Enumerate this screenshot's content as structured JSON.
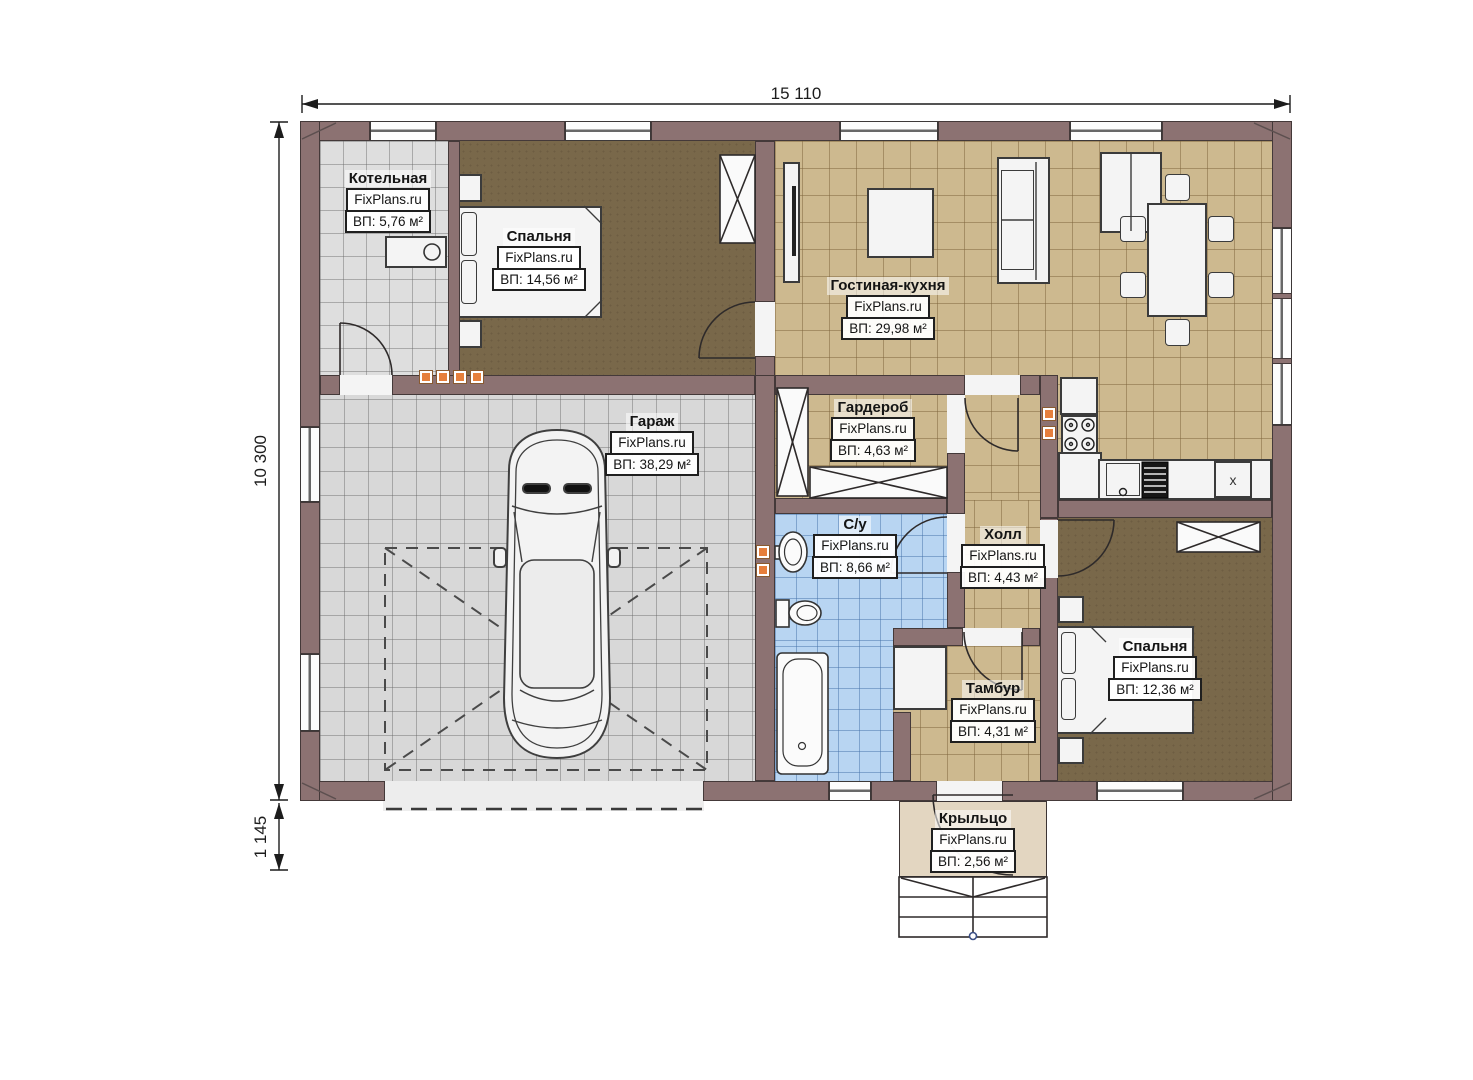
{
  "plan": {
    "watermark": "FixPlans.ru",
    "dimensions": {
      "width_label": "15 110",
      "height_label": "10 300",
      "porch_label": "1 145"
    },
    "kitchen": {
      "x_label": "x"
    },
    "rooms": [
      {
        "id": "boiler",
        "name": "Котельная",
        "area": "ВП: 5,76 м²"
      },
      {
        "id": "bedroom1",
        "name": "Спальня",
        "area": "ВП: 14,56 м²"
      },
      {
        "id": "living",
        "name": "Гостиная-кухня",
        "area": "ВП: 29,98 м²"
      },
      {
        "id": "garage",
        "name": "Гараж",
        "area": "ВП: 38,29 м²"
      },
      {
        "id": "wardrobe",
        "name": "Гардероб",
        "area": "ВП: 4,63 м²"
      },
      {
        "id": "bath",
        "name": "С/у",
        "area": "ВП: 8,66 м²"
      },
      {
        "id": "hall",
        "name": "Холл",
        "area": "ВП: 4,43 м²"
      },
      {
        "id": "tambour",
        "name": "Тамбур",
        "area": "ВП: 4,31 м²"
      },
      {
        "id": "bedroom2",
        "name": "Спальня",
        "area": "ВП: 12,36 м²"
      },
      {
        "id": "porch",
        "name": "Крыльцо",
        "area": "ВП: 2,56 м²"
      }
    ]
  }
}
